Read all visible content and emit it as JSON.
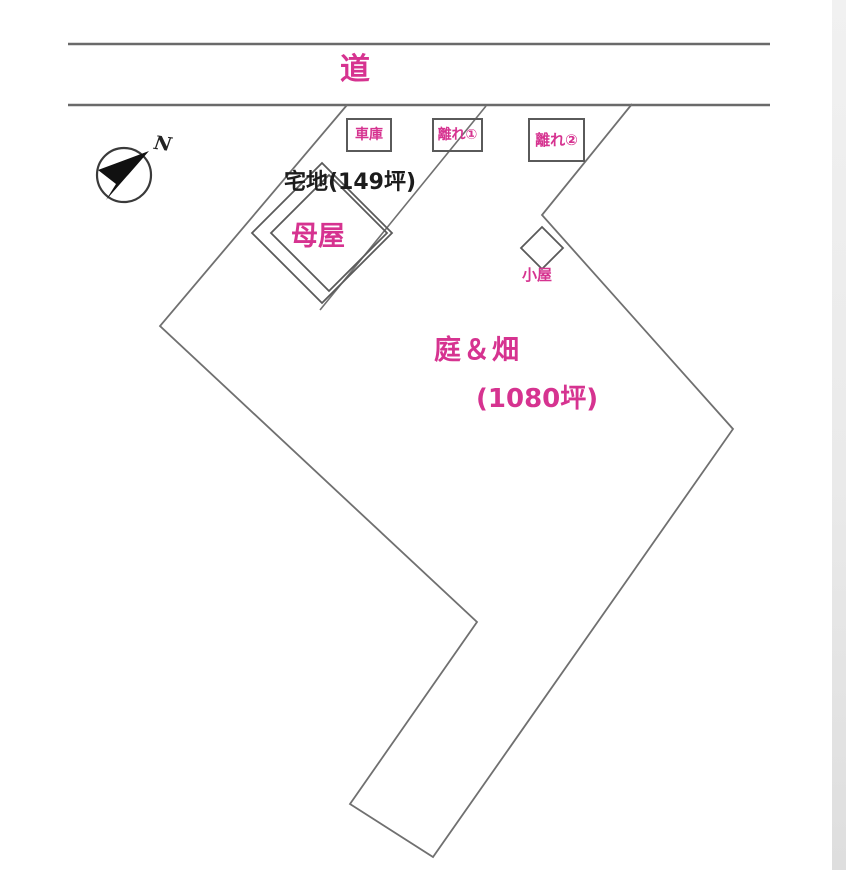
{
  "colors": {
    "accent": "#d63390",
    "line": "#6f6f6f",
    "ink": "#1c1c1c"
  },
  "road": {
    "label": "道"
  },
  "compass": {
    "north_label": "N"
  },
  "buildings": {
    "garage": "車庫",
    "annex1": "離れ①",
    "annex2": "離れ②",
    "main_house": "母屋",
    "shed": "小屋"
  },
  "areas": {
    "residential": "宅地(149坪)",
    "garden": "庭＆畑",
    "garden_size": "(1080坪)"
  }
}
